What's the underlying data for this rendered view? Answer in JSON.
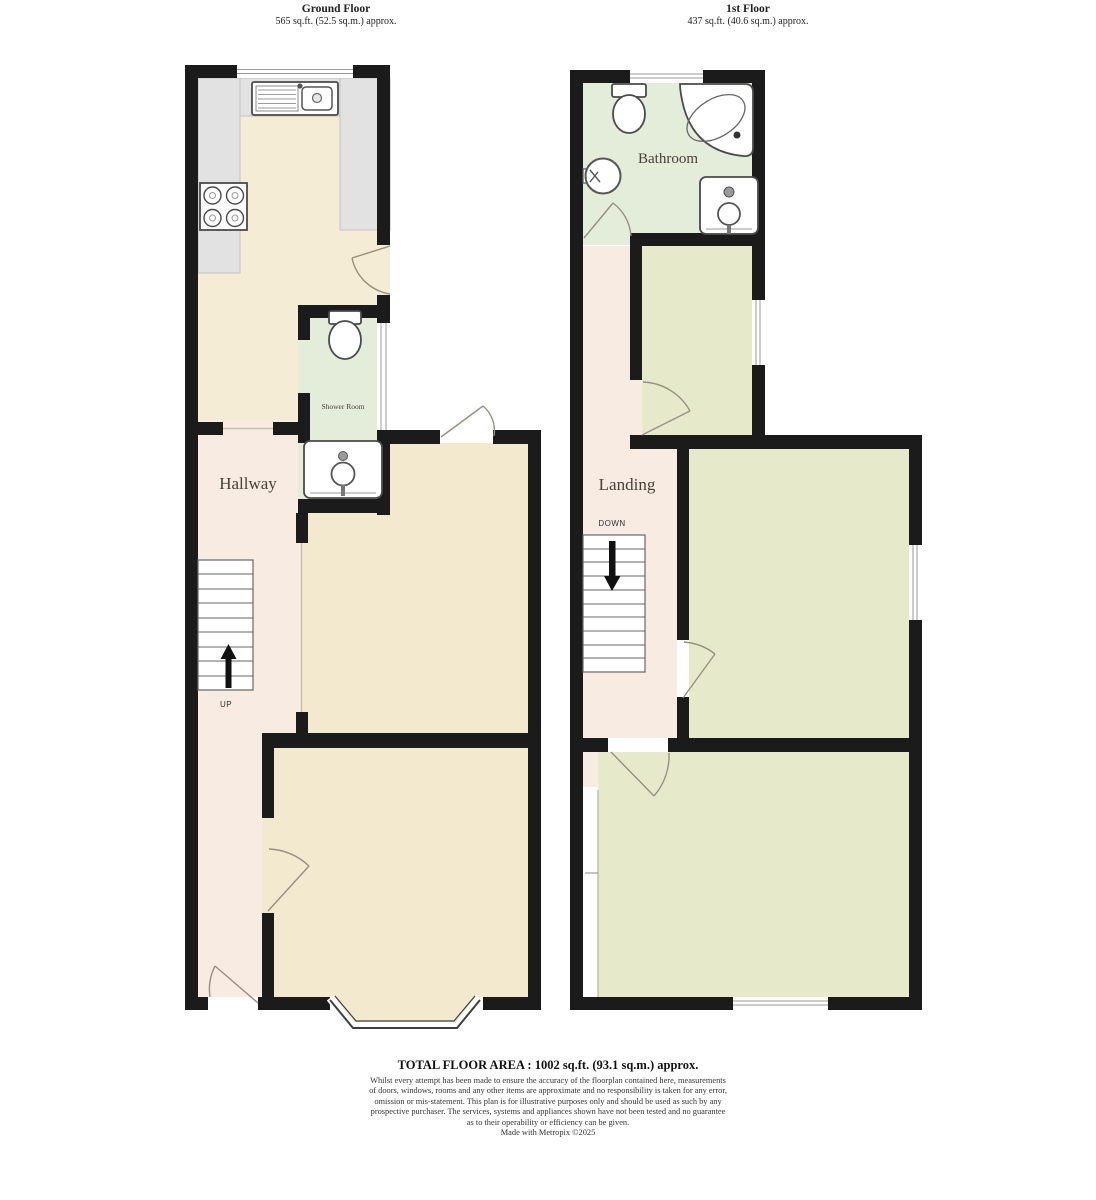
{
  "ground_floor": {
    "title": "Ground Floor",
    "area": "565 sq.ft. (52.5 sq.m.) approx.",
    "labels": {
      "hallway": "Hallway",
      "shower_room": "Shower Room",
      "up": "UP"
    }
  },
  "first_floor": {
    "title": "1st Floor",
    "area": "437 sq.ft. (40.6 sq.m.) approx.",
    "labels": {
      "bathroom": "Bathroom",
      "landing": "Landing",
      "down": "DOWN"
    }
  },
  "footer": {
    "total_area": "TOTAL FLOOR AREA : 1002 sq.ft. (93.1 sq.m.) approx.",
    "disclaimer_lines": [
      "Whilst every attempt has been made to ensure the accuracy of the floorplan contained here, measurements",
      "of doors, windows, rooms and any other items are approximate and no responsibility is taken for any error,",
      "omission or mis-statement. This plan is for illustrative purposes only and should be used as such by any",
      "prospective purchaser. The services, systems and appliances shown have not been tested and no guarantee",
      "as to their operability or efficiency can be given.",
      "Made with Metropix ©2025"
    ]
  },
  "colors": {
    "wall": "#1b1b1b",
    "hallway_floor": "#f8ece2",
    "reception_floor": "#f2e9cf",
    "kitchen_floor": "#f4ecd4",
    "counter": "#e2e2e2",
    "wet_room_floor": "#e3edda",
    "bedroom_floor": "#e6eaca"
  }
}
